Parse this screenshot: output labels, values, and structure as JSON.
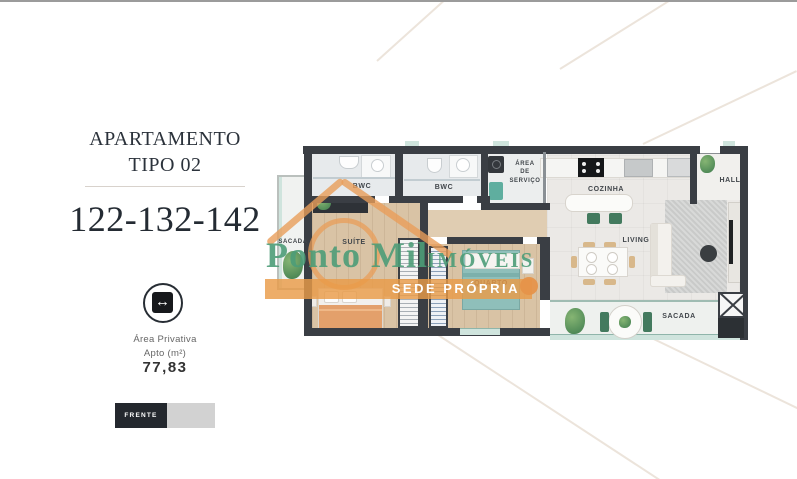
{
  "page": {
    "top_border_color": "#9b9b9b",
    "background": "#ffffff"
  },
  "info_panel": {
    "title_line1": "APARTAMENTO",
    "title_line2": "TIPO 02",
    "unit_numbers": "122-132-142",
    "area_icon": "horizontal-width-arrow-icon",
    "arrow_glyph": "↔",
    "area_label_line1": "Área Privativa",
    "area_label_line2": "Apto (m²)",
    "area_value": "77,83",
    "orientation_label": "FRENTE"
  },
  "watermark": {
    "brand_name": "Ponto Mil",
    "brand_suffix": "IMÓVEIS",
    "banner_text": "SEDE PRÓPRIA",
    "orange": "#e79a55",
    "green": "#4ba37f"
  },
  "floorplan": {
    "wall_color": "#3a3e44",
    "wood_floor_color": "#d9c3a5",
    "tile_floor_color": "#ebe9e6",
    "glass_color": "#cfe4dd",
    "labels": {
      "sacada_suite": "SACADA",
      "suite": "SUÍTE",
      "bwc_suite": "BWC",
      "bwc_social": "BWC",
      "area_servico": "ÁREA\nDE\nSERVIÇO",
      "cozinha": "COZINHA",
      "hall": "HALL",
      "living": "LIVING",
      "quarto": "QUARTO",
      "sacada_living": "SACADA"
    }
  }
}
